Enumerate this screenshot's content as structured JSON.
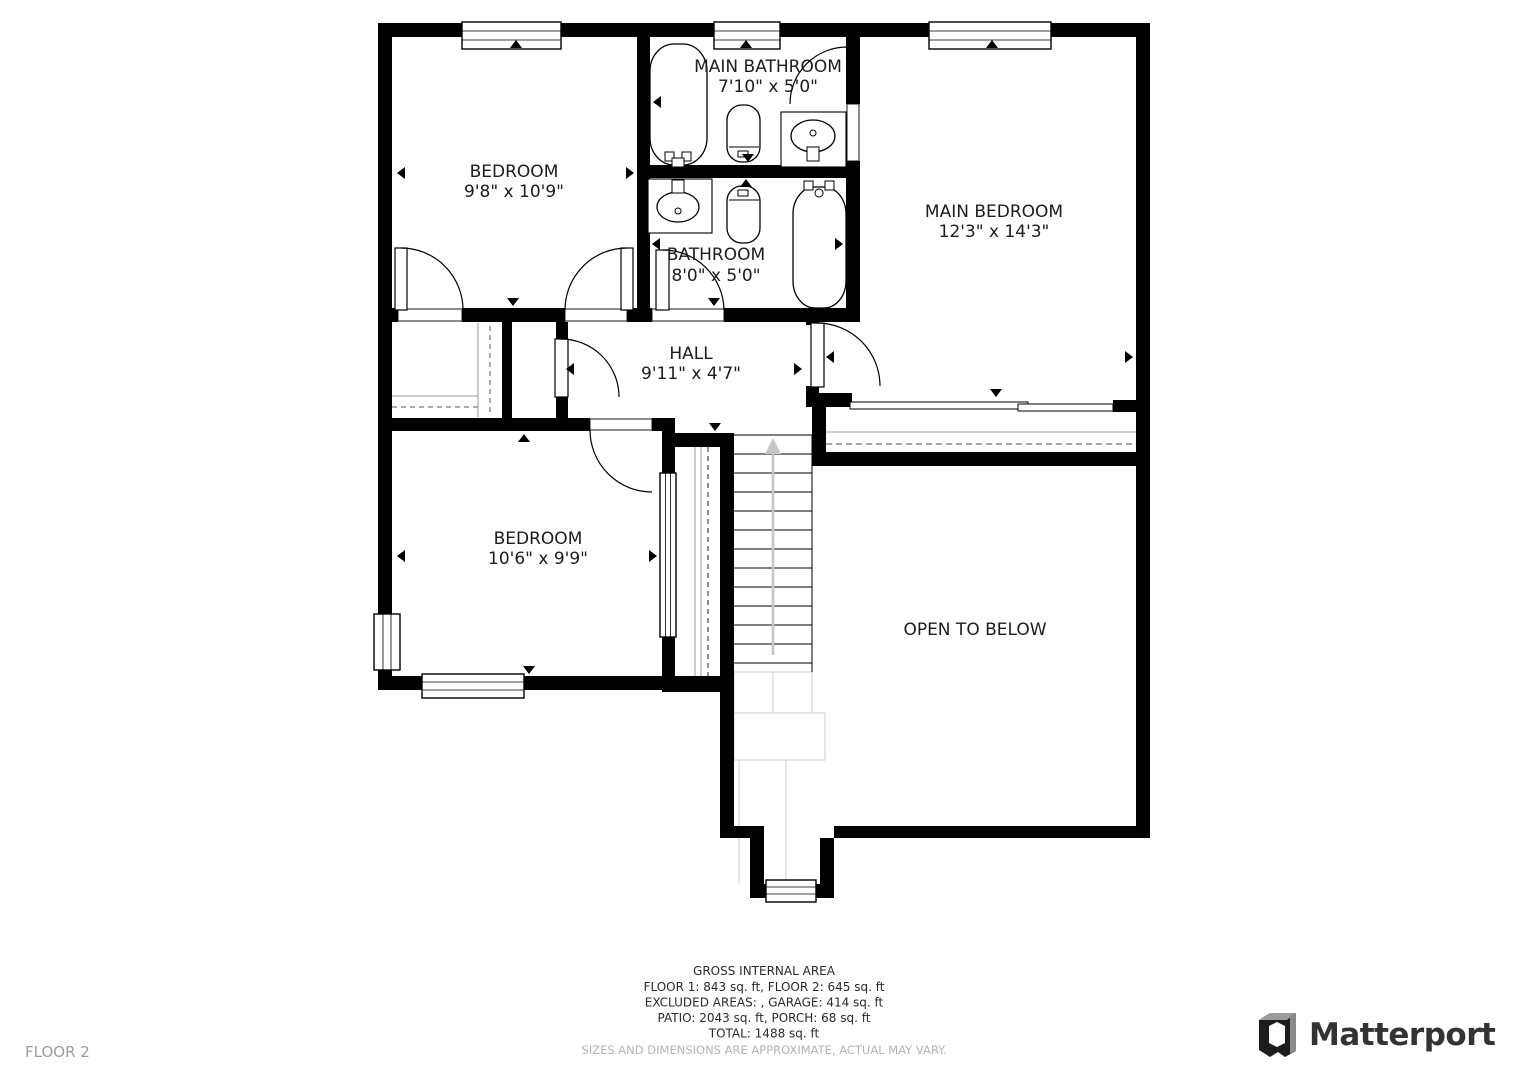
{
  "floor_label": "FLOOR 2",
  "plan": {
    "rooms": [
      {
        "name": "BEDROOM",
        "dims": "9'8\" x 10'9\""
      },
      {
        "name": "MAIN BATHROOM",
        "dims": "7'10\" x 5'0\""
      },
      {
        "name": "MAIN BEDROOM",
        "dims": "12'3\" x 14'3\""
      },
      {
        "name": "BATHROOM",
        "dims": "8'0\" x 5'0\""
      },
      {
        "name": "HALL",
        "dims": "9'11\" x 4'7\""
      },
      {
        "name": "BEDROOM",
        "dims": "10'6\" x 9'9\""
      },
      {
        "name": "OPEN TO BELOW",
        "dims": ""
      }
    ]
  },
  "footer": {
    "title": "GROSS INTERNAL AREA",
    "line1": "FLOOR 1: 843 sq. ft, FLOOR 2: 645 sq. ft",
    "line2": "EXCLUDED AREAS: , GARAGE: 414 sq. ft",
    "line3": "PATIO: 2043 sq. ft, PORCH: 68 sq. ft",
    "line4": "TOTAL: 1488 sq. ft",
    "disclaimer": "SIZES AND DIMENSIONS ARE APPROXIMATE, ACTUAL MAY VARY."
  },
  "brand": {
    "wordmark": "Matterport"
  },
  "colors": {
    "wall": "#000000",
    "label": "#1c1c1c",
    "muted_gray": "#9d9d9d",
    "disclaimer_gray": "#b3b3b3",
    "brand_dark": "#333333",
    "stair_arrow": "#c6c6c6"
  }
}
